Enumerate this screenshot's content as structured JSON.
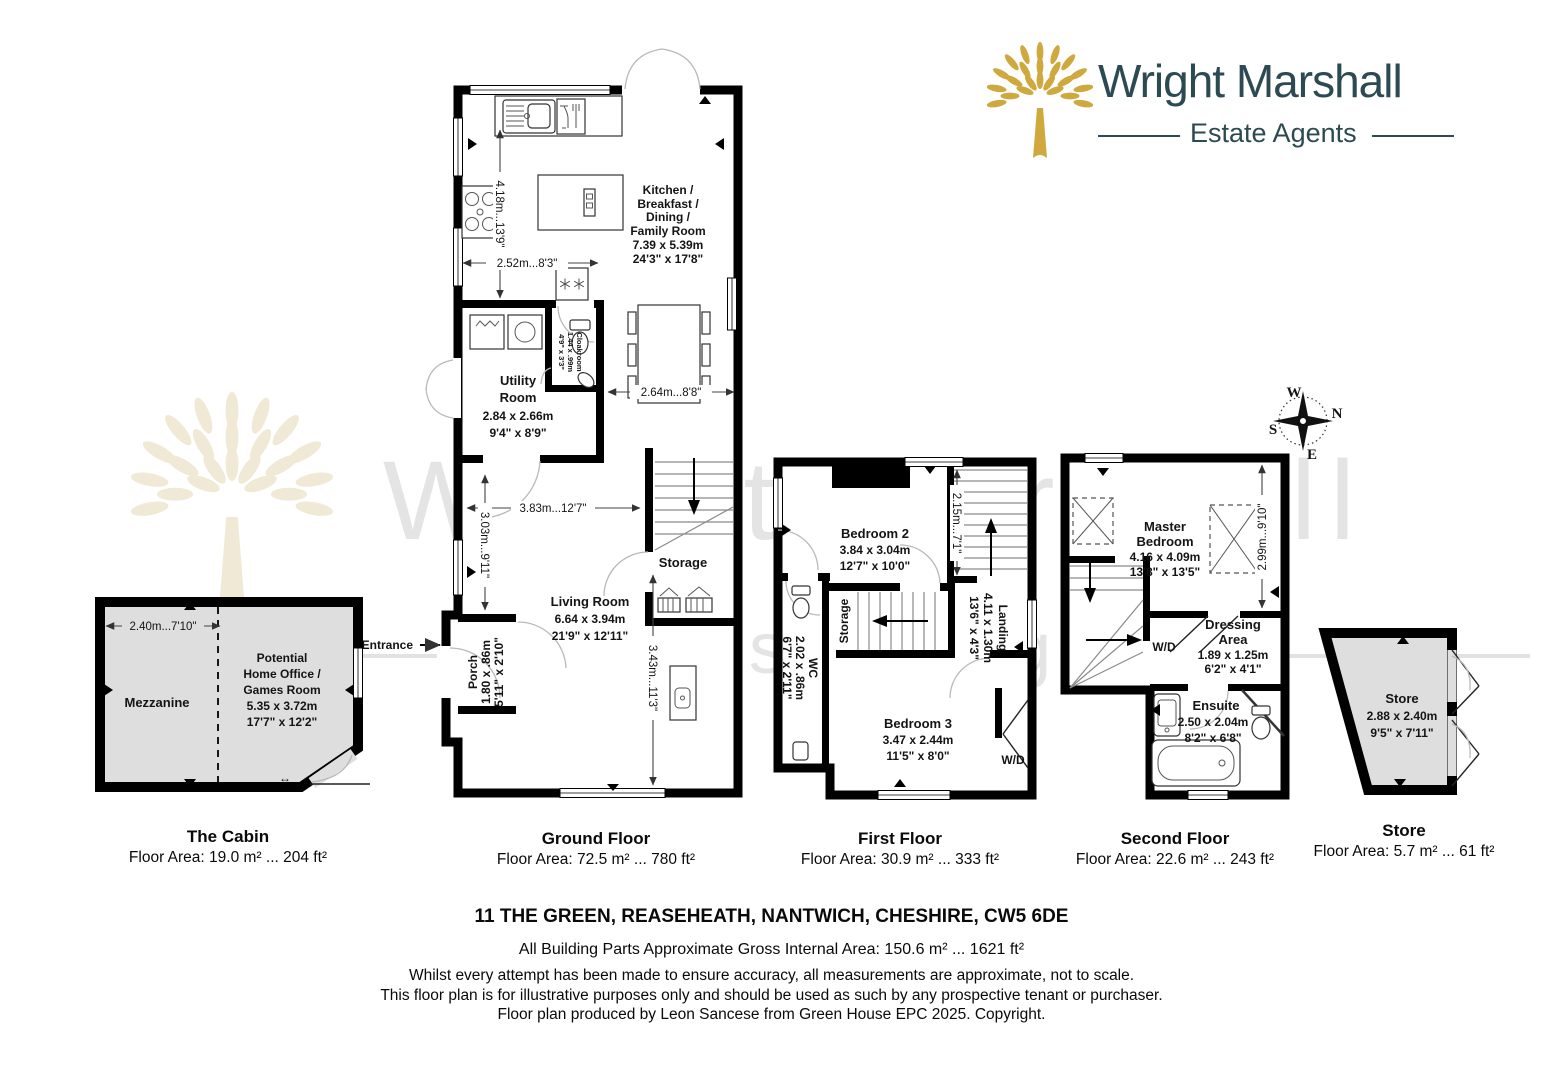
{
  "logo": {
    "brand": "Wright Marshall",
    "tagline": "Estate Agents"
  },
  "colors": {
    "brand_teal": "#2c4a52",
    "logo_gold": "#cfa93d",
    "watermark_grey": "#e4e4e4",
    "watermark_beige": "#f0e9d6",
    "outbuilding_fill": "#dedede"
  },
  "watermark": {
    "line1": "Wright Marshall",
    "line2": "Estate Agents"
  },
  "compass": {
    "top": "W",
    "right": "N",
    "left": "S",
    "bottom": "E"
  },
  "entrance_label": "Entrance",
  "plans": {
    "cabin": {
      "title": "The Cabin",
      "area": "Floor Area: 19.0 m² ... 204 ft²",
      "mezzanine": "Mezzanine",
      "office": [
        "Potential",
        "Home Office /",
        "Games Room",
        "5.35 x 3.72m",
        "17'7\" x 12'2\""
      ],
      "dim_w": "2.40m...7'10\""
    },
    "ground": {
      "title": "Ground Floor",
      "area": "Floor Area: 72.5 m² ... 780 ft²",
      "kitchen": [
        "Kitchen /",
        "Breakfast /",
        "Dining /",
        "Family Room",
        "7.39 x 5.39m",
        "24'3\" x 17'8\""
      ],
      "utility": [
        "Utility",
        "Room",
        "2.84 x 2.66m",
        "9'4\" x 8'9\""
      ],
      "cloakroom": [
        "Cloakroom",
        "1.44 x .99m",
        "4'9\" x 3'3\""
      ],
      "living": [
        "Living Room",
        "6.64 x 3.94m",
        "21'9\" x 12'11\""
      ],
      "porch": [
        "Porch",
        "1.80 x .86m",
        "5'11\" x 2'10\""
      ],
      "storage": "Storage",
      "dims": {
        "kitchen_h": "4.18m...13'9\"",
        "kitchen_w": "2.52m...8'3\"",
        "dining_w": "2.64m...8'8\"",
        "living_w": "3.83m...12'7\"",
        "living_h1": "3.03m...9'11\"",
        "living_h2": "3.43m...11'3\""
      }
    },
    "first": {
      "title": "First Floor",
      "area": "Floor Area: 30.9 m² ... 333 ft²",
      "bedroom2": [
        "Bedroom 2",
        "3.84 x 3.04m",
        "12'7\" x 10'0\""
      ],
      "bedroom3": [
        "Bedroom 3",
        "3.47 x 2.44m",
        "11'5\" x 8'0\""
      ],
      "landing": [
        "Landing",
        "4.11 x 1.30m",
        "13'6\" x 4'3\""
      ],
      "wc": [
        "WC",
        "2.02 x .86m",
        "6'7\" x 2'11\""
      ],
      "storage": "Storage",
      "wd": "W/D",
      "dims": {
        "stairs_h": "2.15m...7'1\""
      }
    },
    "second": {
      "title": "Second Floor",
      "area": "Floor Area: 22.6 m² ... 243 ft²",
      "master": [
        "Master",
        "Bedroom",
        "4.16 x 4.09m",
        "13'8\" x 13'5\""
      ],
      "dressing": [
        "Dressing",
        "Area",
        "1.89 x 1.25m",
        "6'2\" x 4'1\""
      ],
      "ensuite": [
        "Ensuite",
        "2.50 x 2.04m",
        "8'2\" x 6'8\""
      ],
      "wd": "W/D",
      "dims": {
        "room_h": "2.99m...9'10\""
      }
    },
    "store": {
      "title": "Store",
      "area": "Floor Area: 5.7 m² ... 61 ft²",
      "label": [
        "Store",
        "2.88 x 2.40m",
        "9'5\" x 7'11\""
      ]
    }
  },
  "footer": {
    "address": "11 THE GREEN, REASEHEATH, NANTWICH, CHESHIRE, CW5 6DE",
    "gross": "All Building Parts Approximate Gross Internal Area: 150.6 m² ... 1621 ft²",
    "disclaimers": [
      "Whilst every attempt has been made to ensure accuracy, all measurements are approximate, not to scale.",
      "This floor plan is for illustrative purposes only and should be used as such by any prospective tenant or purchaser.",
      "Floor plan produced by Leon Sancese from Green House EPC 2025. Copyright."
    ]
  }
}
